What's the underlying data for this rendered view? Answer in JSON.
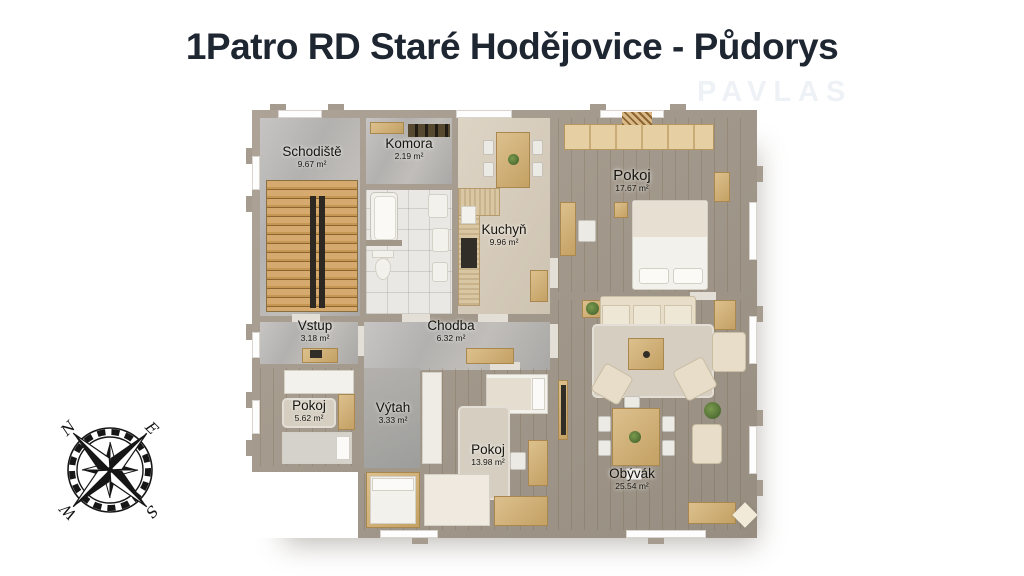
{
  "page": {
    "title": "1Patro RD Staré Hodějovice - Půdorys",
    "watermark": "PAVLAS"
  },
  "compass": {
    "north": "N",
    "east": "E",
    "south": "S",
    "west": "W"
  },
  "rooms": [
    {
      "id": "schodiste",
      "name": "Schodiště",
      "area": "9.67 m²"
    },
    {
      "id": "komora",
      "name": "Komora",
      "area": "2.19 m²"
    },
    {
      "id": "kuchyn",
      "name": "Kuchyň",
      "area": "9.96 m²"
    },
    {
      "id": "pokoj-velky",
      "name": "Pokoj",
      "area": "17.67 m²"
    },
    {
      "id": "vstup",
      "name": "Vstup",
      "area": "3.18 m²"
    },
    {
      "id": "chodba",
      "name": "Chodba",
      "area": "6.32 m²"
    },
    {
      "id": "pokoj-maly",
      "name": "Pokoj",
      "area": "5.62 m²"
    },
    {
      "id": "vytah",
      "name": "Výtah",
      "area": "3.33 m²"
    },
    {
      "id": "pokoj-stredni",
      "name": "Pokoj",
      "area": "13.98 m²"
    },
    {
      "id": "obyvak",
      "name": "Obývák",
      "area": "25.54 m²"
    }
  ],
  "colors": {
    "wall": "#a1988a",
    "floor_gray": "#b9b7b4",
    "floor_tile": "#eae8e4",
    "floor_beige": "#d6cbbb",
    "wood_light": "#c9995f",
    "wood_rich": "#b98a4e",
    "title_text": "#1e2631"
  }
}
